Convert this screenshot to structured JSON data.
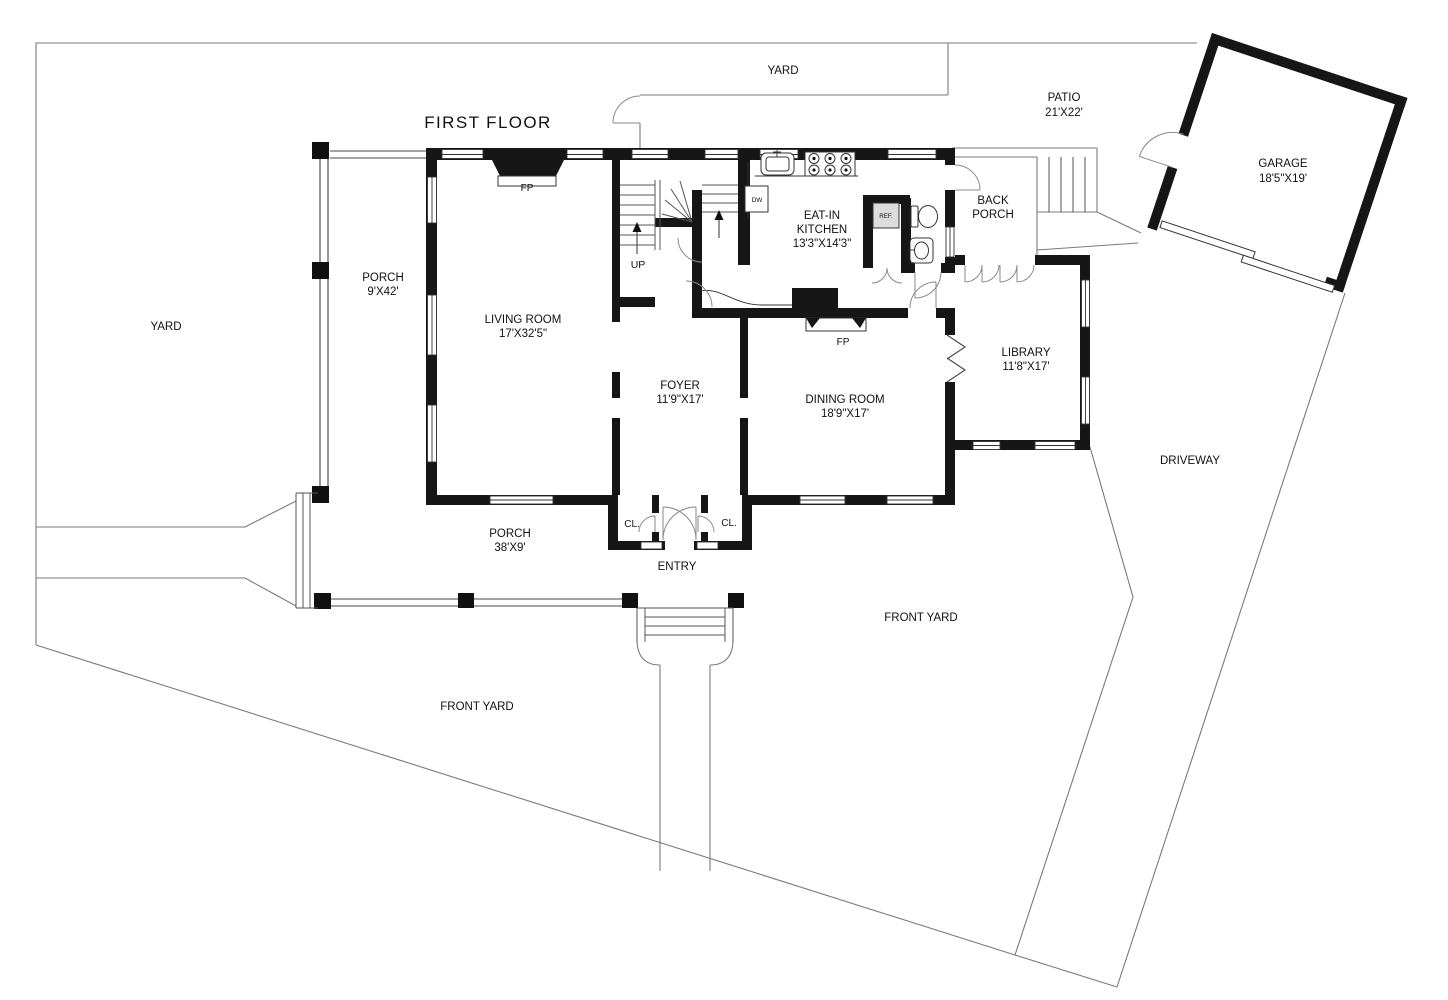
{
  "meta": {
    "drawing_type": "residential first-floor plan with site"
  },
  "colors": {
    "background": "#ffffff",
    "walls": "#161616",
    "site_lines": "#7a7a7a",
    "text": "#111111",
    "appliance_fill": "#dcdcdc"
  },
  "title": "FIRST FLOOR",
  "rooms": [
    {
      "name": "LIVING ROOM",
      "dims": "17'X32'5\""
    },
    {
      "name": "EAT-IN KITCHEN",
      "dims": "13'3\"X14'3\""
    },
    {
      "name": "FOYER",
      "dims": "11'9\"X17'"
    },
    {
      "name": "DINING ROOM",
      "dims": "18'9\"X17'"
    },
    {
      "name": "LIBRARY",
      "dims": "11'8\"X17'"
    },
    {
      "name": "GARAGE",
      "dims": "18'5\"X19'"
    },
    {
      "name": "PATIO",
      "dims": "21'X22'"
    },
    {
      "name": "PORCH (side)",
      "dims": "9'X42'"
    },
    {
      "name": "PORCH (front)",
      "dims": "38'X9'"
    },
    {
      "name": "BACK PORCH",
      "dims": ""
    },
    {
      "name": "ENTRY",
      "dims": ""
    }
  ],
  "labels": [
    {
      "id": "title",
      "lines": [
        "FIRST FLOOR"
      ],
      "x": 488,
      "y": 128,
      "size": 17,
      "ls": 1.4
    },
    {
      "id": "yard-top",
      "lines": [
        "YARD"
      ],
      "x": 783,
      "y": 74,
      "size": 11.5
    },
    {
      "id": "patio",
      "lines": [
        "PATIO",
        "21'X22'"
      ],
      "x": 1064,
      "y": 101,
      "size": 11.5,
      "lh": 15
    },
    {
      "id": "garage",
      "lines": [
        "GARAGE",
        "18'5\"X19'"
      ],
      "x": 1283,
      "y": 167,
      "size": 11.5,
      "lh": 15
    },
    {
      "id": "back-porch",
      "lines": [
        "BACK",
        "PORCH"
      ],
      "x": 993,
      "y": 204,
      "size": 11.5,
      "lh": 14
    },
    {
      "id": "eat-in-kitchen",
      "lines": [
        "EAT-IN",
        "KITCHEN",
        "13'3\"X14'3\""
      ],
      "x": 822,
      "y": 219,
      "size": 11.5,
      "lh": 14
    },
    {
      "id": "up",
      "lines": [
        "UP"
      ],
      "x": 638,
      "y": 268,
      "size": 10.5
    },
    {
      "id": "porch-side",
      "lines": [
        "PORCH",
        "9'X42'"
      ],
      "x": 383,
      "y": 281,
      "size": 11.5,
      "lh": 14
    },
    {
      "id": "living-room",
      "lines": [
        "LIVING ROOM",
        "17'X32'5\""
      ],
      "x": 523,
      "y": 323,
      "size": 11.5,
      "lh": 14
    },
    {
      "id": "yard-left",
      "lines": [
        "YARD"
      ],
      "x": 166,
      "y": 330,
      "size": 11.5
    },
    {
      "id": "fp-living",
      "lines": [
        "FP"
      ],
      "x": 527,
      "y": 191,
      "size": 10
    },
    {
      "id": "fp-dining",
      "lines": [
        "FP"
      ],
      "x": 843,
      "y": 345,
      "size": 10
    },
    {
      "id": "foyer",
      "lines": [
        "FOYER",
        "11'9\"X17'"
      ],
      "x": 680,
      "y": 389,
      "size": 11.5,
      "lh": 14
    },
    {
      "id": "dining-room",
      "lines": [
        "DINING ROOM",
        "18'9\"X17'"
      ],
      "x": 845,
      "y": 403,
      "size": 11.5,
      "lh": 14
    },
    {
      "id": "library",
      "lines": [
        "LIBRARY",
        "11'8\"X17'"
      ],
      "x": 1026,
      "y": 356,
      "size": 11.5,
      "lh": 14
    },
    {
      "id": "driveway",
      "lines": [
        "DRIVEWAY"
      ],
      "x": 1190,
      "y": 464,
      "size": 11.5
    },
    {
      "id": "porch-front",
      "lines": [
        "PORCH",
        "38'X9'"
      ],
      "x": 510,
      "y": 537,
      "size": 11.5,
      "lh": 14
    },
    {
      "id": "closet-left",
      "lines": [
        "CL."
      ],
      "x": 632,
      "y": 527,
      "size": 10
    },
    {
      "id": "closet-right",
      "lines": [
        "CL."
      ],
      "x": 729,
      "y": 526,
      "size": 10
    },
    {
      "id": "entry",
      "lines": [
        "ENTRY"
      ],
      "x": 677,
      "y": 570,
      "size": 11.5
    },
    {
      "id": "front-yard-right",
      "lines": [
        "FRONT YARD"
      ],
      "x": 921,
      "y": 621,
      "size": 11.5
    },
    {
      "id": "front-yard-left",
      "lines": [
        "FRONT YARD"
      ],
      "x": 477,
      "y": 710,
      "size": 11.5
    },
    {
      "id": "dishwasher",
      "lines": [
        "DW"
      ],
      "x": 757,
      "y": 202,
      "size": 6.5
    },
    {
      "id": "refrigerator",
      "lines": [
        "REF."
      ],
      "x": 886,
      "y": 218,
      "size": 6.2
    }
  ]
}
